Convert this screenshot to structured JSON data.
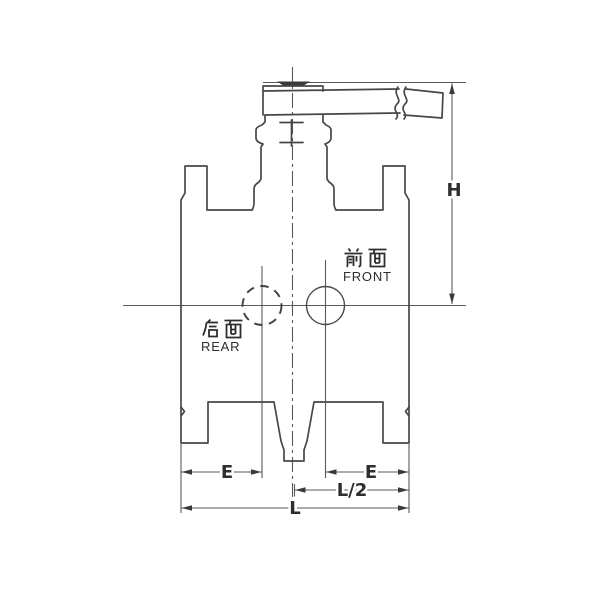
{
  "drawing": {
    "labels": {
      "front_cn": "前面",
      "front_en": "FRONT",
      "rear_cn": "后面",
      "rear_en": "REAR"
    },
    "dimensions": {
      "h": "H",
      "e_left": "E",
      "e_right": "E",
      "l_half": "L/2",
      "l": "L"
    },
    "colors": {
      "background": "#ffffff",
      "outline": "#474747",
      "thin_line": "#5a5a5a",
      "text": "#2e2e2e"
    }
  }
}
